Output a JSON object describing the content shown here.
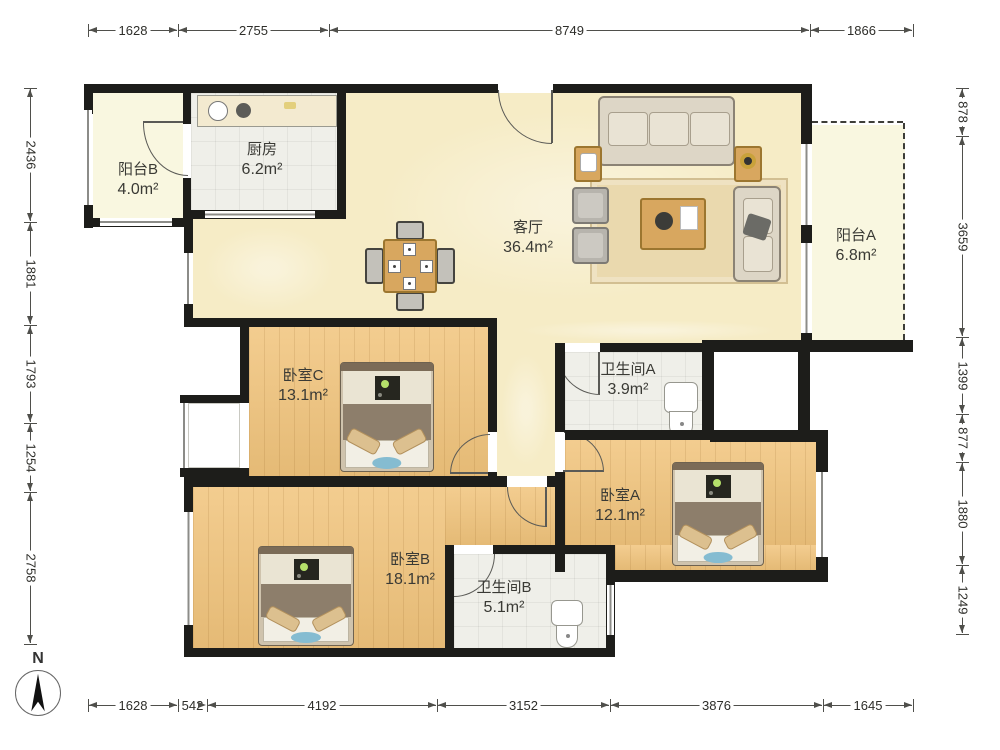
{
  "plan": {
    "rooms": [
      {
        "id": "balcony-b",
        "name": "阳台B",
        "area": "4.0m²"
      },
      {
        "id": "kitchen",
        "name": "厨房",
        "area": "6.2m²"
      },
      {
        "id": "living",
        "name": "客厅",
        "area": "36.4m²"
      },
      {
        "id": "balcony-a",
        "name": "阳台A",
        "area": "6.8m²"
      },
      {
        "id": "bedroom-c",
        "name": "卧室C",
        "area": "13.1m²"
      },
      {
        "id": "bathroom-a",
        "name": "卫生间A",
        "area": "3.9m²"
      },
      {
        "id": "bedroom-a",
        "name": "卧室A",
        "area": "12.1m²"
      },
      {
        "id": "bedroom-b",
        "name": "卧室B",
        "area": "18.1m²"
      },
      {
        "id": "bathroom-b",
        "name": "卫生间B",
        "area": "5.1m²"
      }
    ],
    "dimensions": {
      "top": [
        "1628",
        "2755",
        "8749",
        "1866"
      ],
      "bottom": [
        "1628",
        "542",
        "4192",
        "3152",
        "3876",
        "1645"
      ],
      "left": [
        "2436",
        "1881",
        "1793",
        "1254",
        "2758"
      ],
      "right": [
        "878",
        "3659",
        "1399",
        "877",
        "1880",
        "1249"
      ]
    },
    "compass": {
      "label": "N"
    },
    "colors": {
      "wall": "#1d1d1a",
      "wood": "#f1c47c",
      "tile": "#efefe9",
      "living": "#f6ecc6",
      "balcony": "#f9f7e0"
    }
  }
}
